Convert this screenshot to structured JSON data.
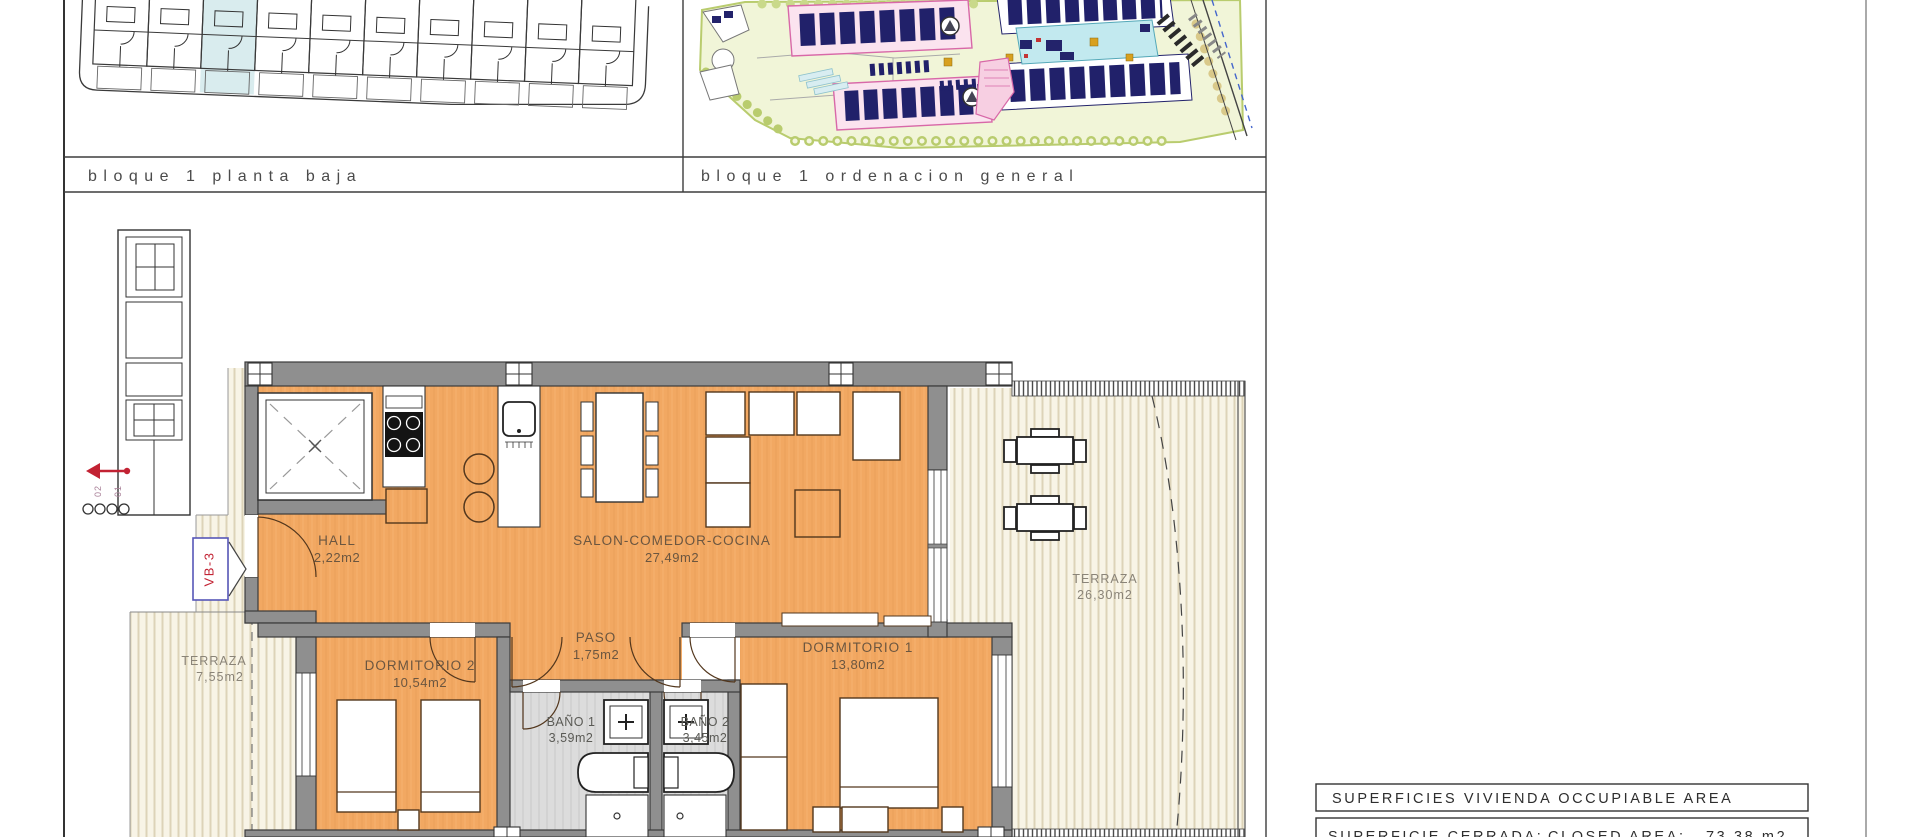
{
  "sheet": {
    "panel1_label": "bloque 1 planta baja",
    "panel2_label": "bloque 1 ordenacion general"
  },
  "floor_plan": {
    "rooms": {
      "hall": {
        "name": "HALL",
        "area": "2,22m2"
      },
      "salon": {
        "name": "SALON-COMEDOR-COCINA",
        "area": "27,49m2"
      },
      "paso": {
        "name": "PASO",
        "area": "1,75m2"
      },
      "dormitorio1": {
        "name": "DORMITORIO 1",
        "area": "13,80m2"
      },
      "dormitorio2": {
        "name": "DORMITORIO 2",
        "area": "10,54m2"
      },
      "bano1": {
        "name": "BAÑO 1",
        "area": "3,59m2"
      },
      "bano2": {
        "name": "BAÑO 2",
        "area": "3,45m2"
      },
      "terraza_main": {
        "name": "TERRAZA",
        "area": "26,30m2"
      },
      "terraza_small": {
        "name": "TERRAZA",
        "area": "7,55m2"
      }
    },
    "markers": {
      "section_tag": "VB-3",
      "stair_label_left": "02",
      "stair_label_right": "01"
    }
  },
  "summary_table": {
    "title": "SUPERFICIES VIVIENDA OCCUPIABLE AREA",
    "rows": [
      {
        "label_es": "SUPERFICIE CERRADA:",
        "label_en": "CLOSED AREA:",
        "value": "73,38 m2"
      }
    ]
  },
  "colors": {
    "floor_orange": "#f2a862",
    "wall_gray": "#8f8f8f",
    "terrace_cream": "#f8f4e6",
    "bath_gray": "#dcdcdc",
    "highlight_unit_blue": "#d9ecee",
    "marker_red": "#c22233",
    "marker_blue": "#5656b8",
    "site_green": "#f1f5d8",
    "site_navy": "#23236b",
    "site_pink": "#d868a8",
    "pool_cyan": "#c2e9ef"
  }
}
